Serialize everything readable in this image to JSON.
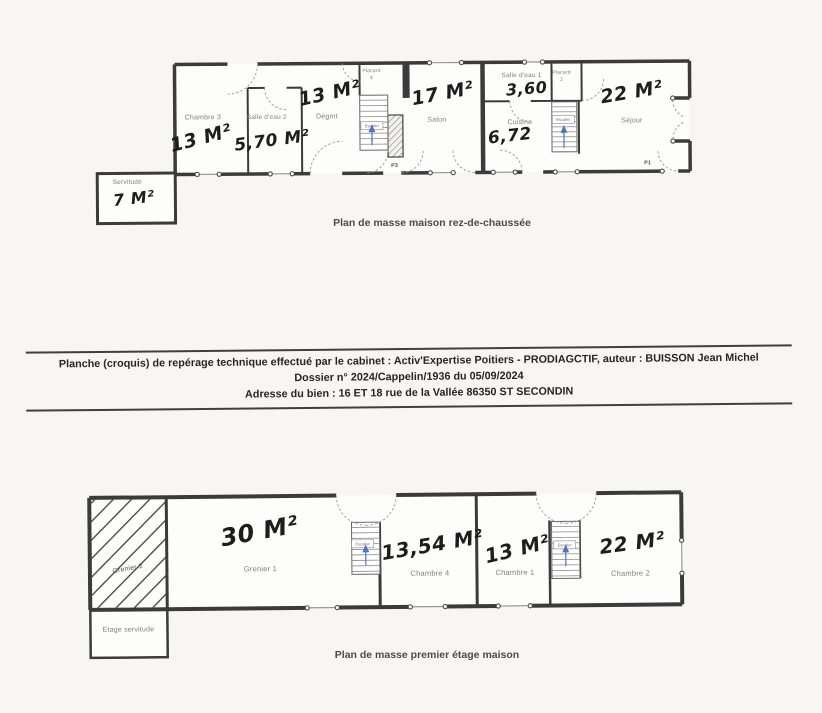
{
  "colors": {
    "paper": "#f7f6f2",
    "wall": "#3b3b3b",
    "room_fill": "#fdfdfb",
    "printed_label": "#7e7e7e",
    "handwriting": "#1d1d1d",
    "caption": "#4b4b4b",
    "stair_arrow_blue": "#4f74c0",
    "door_arc": "#9a9a9a"
  },
  "plan_ground": {
    "caption": "Plan de masse maison rez-de-chaussée",
    "rooms": {
      "chambre3": {
        "label": "Chambre 3",
        "area": "13 M²"
      },
      "salle_eau2": {
        "label": "Salle d'eau 2",
        "area": "5,70 M²"
      },
      "degagement": {
        "label": "Dégmt",
        "area": "13 M²"
      },
      "salon": {
        "label": "Salon",
        "area": "17 M²"
      },
      "salle_eau1": {
        "label": "Salle d'eau 1",
        "area": "3,60"
      },
      "cuisine": {
        "label": "Cuisine",
        "area": "6,72"
      },
      "sejour": {
        "label": "Séjour",
        "area": "22 M²"
      },
      "servitude": {
        "label": "Servitude",
        "area": "7 M²"
      },
      "placard4": {
        "label": "Placard",
        "num": "4"
      },
      "placard2": {
        "label": "Placard",
        "num": "2"
      }
    },
    "stairs": {
      "left": {
        "label": "Escalier",
        "num": "2"
      },
      "right": {
        "label": "Escalier",
        "num": "1"
      }
    },
    "doors": {
      "p3": "P3",
      "p1": "P1"
    }
  },
  "info_block": {
    "line1": "Planche (croquis) de repérage technique effectué par le cabinet : Activ'Expertise Poitiers - PRODIAGCTIF, auteur : BUISSON Jean Michel",
    "line2": "Dossier n° 2024/Cappelin/1936 du 05/09/2024",
    "line3": "Adresse du bien : 16 ET 18 rue de la Vallée  86350 ST SECONDIN"
  },
  "plan_first": {
    "caption": "Plan de masse premier étage maison",
    "rooms": {
      "grenier2": {
        "label": "Grenier 2"
      },
      "grenier1": {
        "label": "Grenier 1",
        "area": "30 M²"
      },
      "chambre4": {
        "label": "Chambre 4",
        "area": "13,54 M²"
      },
      "chambre1": {
        "label": "Chambre 1",
        "area": "13 M²"
      },
      "chambre2": {
        "label": "Chambre 2",
        "area": "22 M²"
      },
      "etage_servitude": {
        "label": "Etage servitude"
      }
    },
    "stairs": {
      "left": {
        "label": "Escalier"
      },
      "right": {
        "label": "Escalier"
      }
    }
  }
}
